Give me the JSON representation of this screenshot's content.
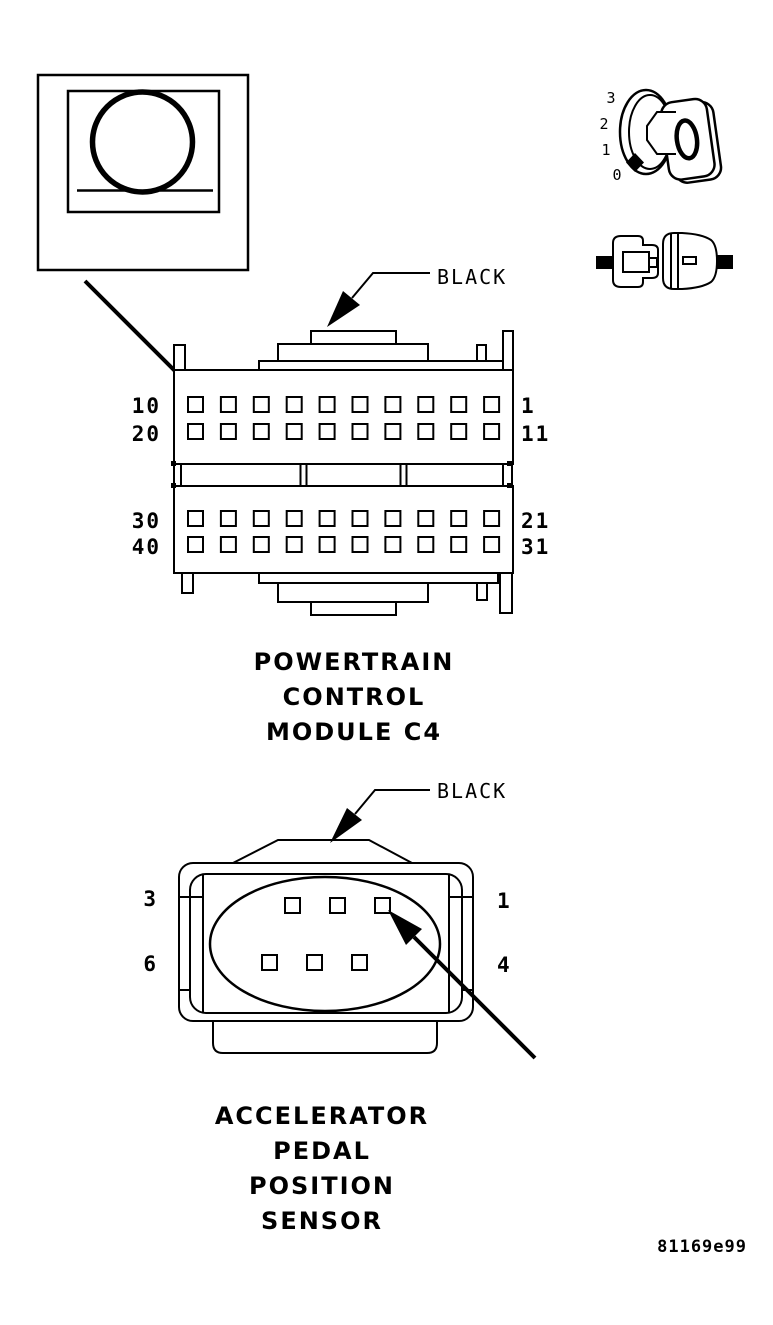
{
  "figure": {
    "code": "81169e99"
  },
  "ignition_switch": {
    "positions": [
      "3",
      "2",
      "1",
      "0"
    ]
  },
  "pcm": {
    "wire_label": "BLACK",
    "caption": [
      "POWERTRAIN",
      "CONTROL",
      "MODULE C4"
    ],
    "pins": {
      "row1_left": "10",
      "row1_right": "1",
      "row2_left": "20",
      "row2_right": "11",
      "row3_left": "30",
      "row3_right": "21",
      "row4_left": "40",
      "row4_right": "31"
    }
  },
  "app_sensor": {
    "wire_label": "BLACK",
    "caption": [
      "ACCELERATOR",
      "PEDAL",
      "POSITION",
      "SENSOR"
    ],
    "pins": {
      "top_left": "3",
      "top_right": "1",
      "bottom_left": "6",
      "bottom_right": "4"
    }
  }
}
